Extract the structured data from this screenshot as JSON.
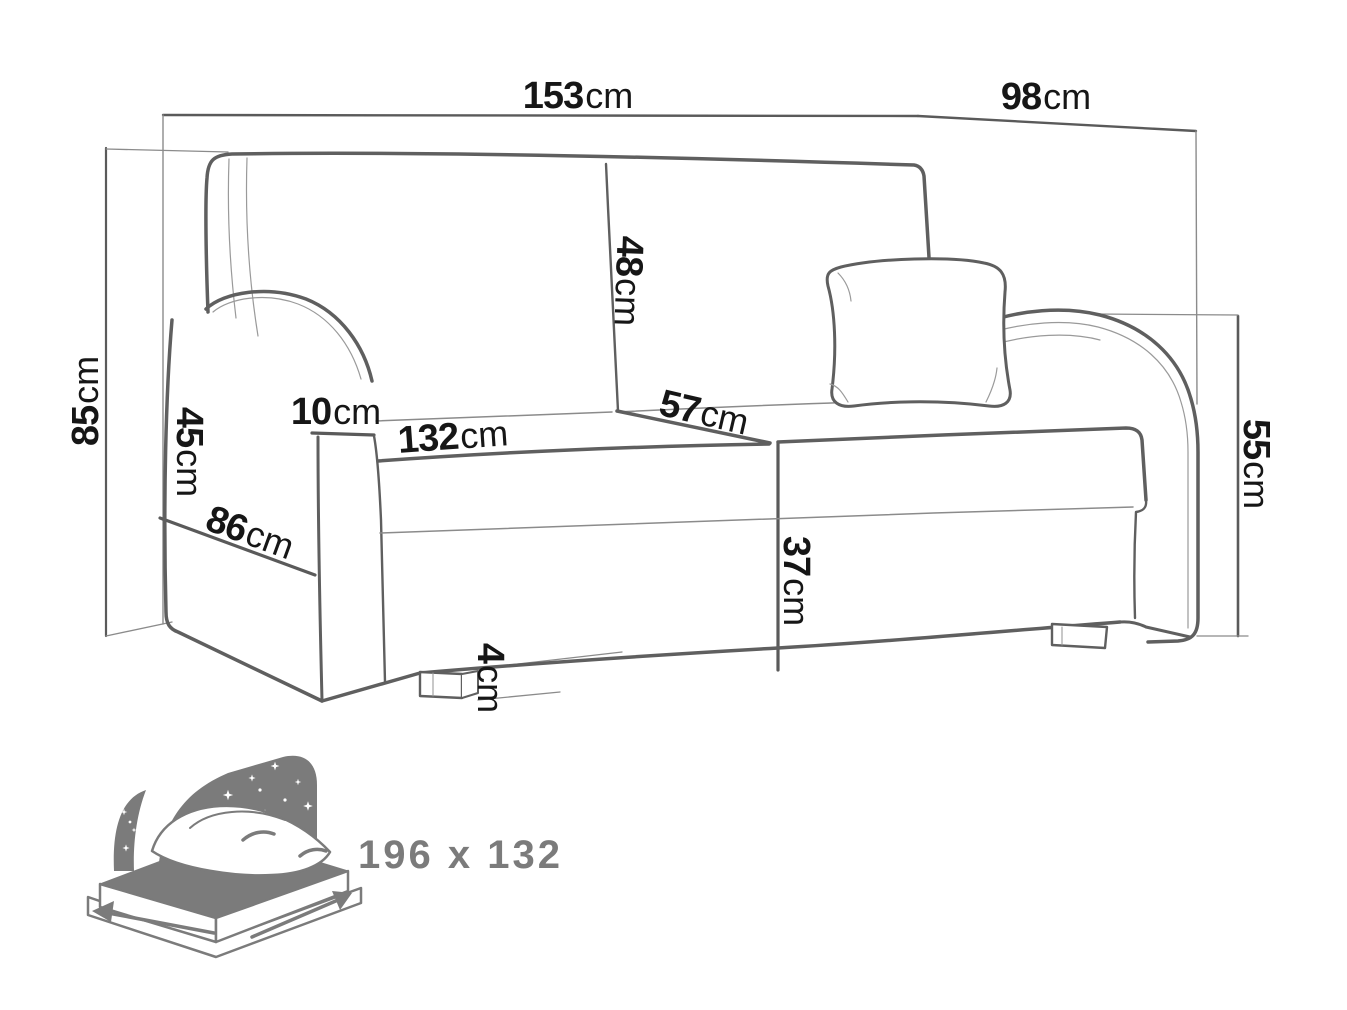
{
  "title": "sofa-dimensions-diagram",
  "colors": {
    "outline": "#5f5f5f",
    "thin_line": "#8b8b8b",
    "label": "#161616",
    "icon_gray": "#7b7b7b",
    "background": "#ffffff"
  },
  "dimensions": [
    {
      "name": "total-width",
      "value": "153",
      "unit": "cm"
    },
    {
      "name": "total-depth",
      "value": "98",
      "unit": "cm"
    },
    {
      "name": "total-height",
      "value": "85",
      "unit": "cm"
    },
    {
      "name": "armrest-height",
      "value": "45",
      "unit": "cm"
    },
    {
      "name": "armrest-width",
      "value": "10",
      "unit": "cm"
    },
    {
      "name": "seat-width",
      "value": "132",
      "unit": "cm"
    },
    {
      "name": "backrest-cushion-height",
      "value": "48",
      "unit": "cm"
    },
    {
      "name": "seat-depth",
      "value": "57",
      "unit": "cm"
    },
    {
      "name": "seat-height",
      "value": "37",
      "unit": "cm"
    },
    {
      "name": "armrest-top-height",
      "value": "55",
      "unit": "cm"
    },
    {
      "name": "side-depth",
      "value": "86",
      "unit": "cm"
    },
    {
      "name": "leg-height",
      "value": "4",
      "unit": "cm"
    }
  ],
  "bed_icon": {
    "name": "sleeping-area-icon",
    "size_label": "196 x 132"
  }
}
